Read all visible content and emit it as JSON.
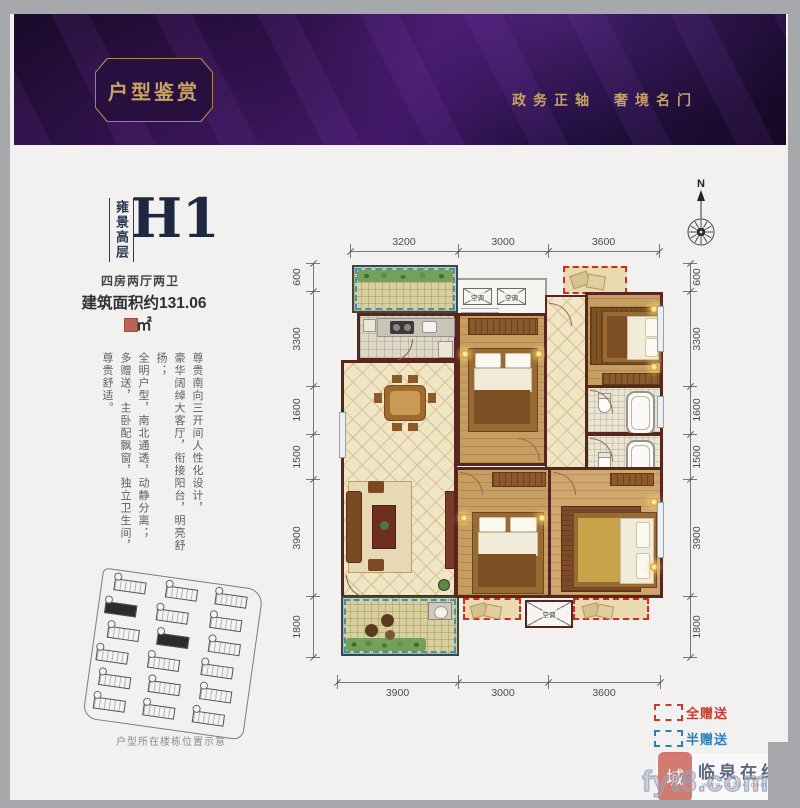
{
  "header": {
    "title": "户型鉴赏",
    "slogan_left": "政务正轴",
    "slogan_right": "奢境名门"
  },
  "unit": {
    "series": "雍景高层",
    "code": "H1",
    "layout": "四房两厅两卫",
    "area": "建筑面积约131.06㎡"
  },
  "description": {
    "lines": [
      "尊贵南向三开间人性化设计，",
      "豪华阔绰大客厅，衔接阳台，明亮舒扬；",
      "全明户型，南北通透，动静分离；",
      "多赠送，主卧配飘窗，独立卫生间，尊贵舒适。"
    ]
  },
  "compass": {
    "label": "N"
  },
  "dimensions": {
    "top": [
      "3200",
      "3000",
      "3600"
    ],
    "bottom": [
      "3900",
      "3000",
      "3600"
    ],
    "left": [
      "600",
      "3300",
      "1600",
      "1500",
      "3900",
      "1800"
    ],
    "right": [
      "600",
      "3300",
      "1600",
      "1500",
      "3900",
      "1800"
    ]
  },
  "plan": {
    "ac_label": "空调"
  },
  "legend": {
    "items": [
      {
        "label": "全赠送",
        "color": "#c43c2e"
      },
      {
        "label": "半赠送",
        "color": "#2e7fb8"
      }
    ]
  },
  "siteplan": {
    "caption": "户型所在楼栋位置示意"
  },
  "watermark": {
    "seal": "城",
    "site_name": "临泉在线",
    "url": "www.lq234.com",
    "domain": "fyt8.com"
  }
}
